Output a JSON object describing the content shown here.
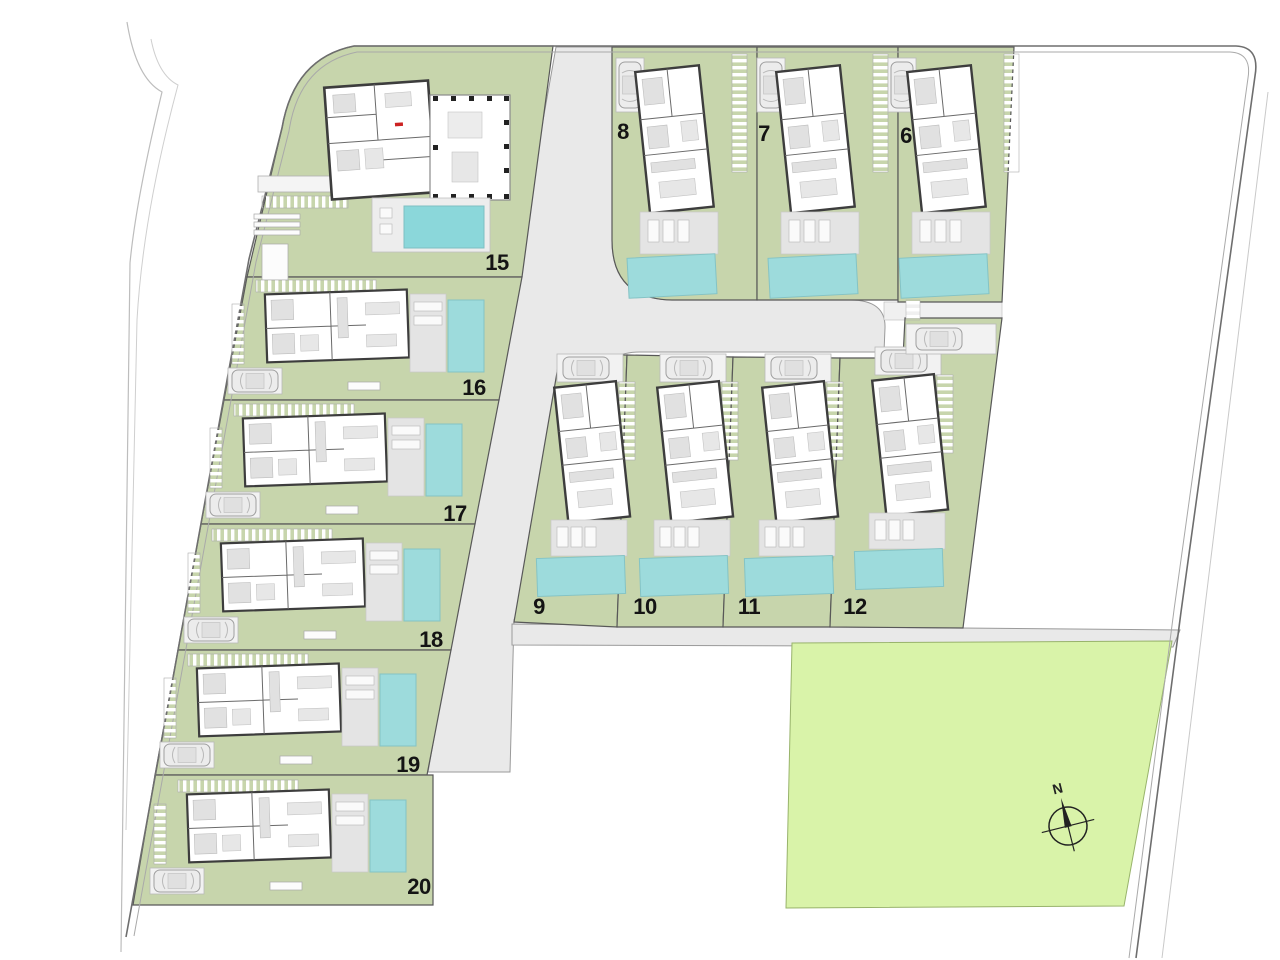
{
  "title": "Villa development site plan",
  "compass": {
    "label": "N",
    "icon": "compass-rose-icon"
  },
  "icons": {
    "car": "car-icon",
    "pool": "pool-shape",
    "compass": "compass-rose-icon"
  },
  "colors": {
    "lawn": "#c7d5ac",
    "open_space": "#d9f3a9",
    "pool": "#9ddbdc",
    "pool_big": "#8bd7da",
    "road": "#e9e9e9",
    "road_edge": "#9a9a9a",
    "boundary": "#6e6e6e",
    "boundary_light": "#a9a9a9",
    "plot_line": "#585858",
    "wall": "#3d3d3d",
    "terrace": "#e4e4e4",
    "furniture": "#e1e1e1",
    "pad": "#f2f2f2",
    "label": "#141414",
    "marker_red": "#cc2222"
  },
  "plots": [
    {
      "label": "15",
      "x": 497,
      "y": 263
    },
    {
      "label": "16",
      "x": 474,
      "y": 388
    },
    {
      "label": "17",
      "x": 455,
      "y": 514
    },
    {
      "label": "18",
      "x": 431,
      "y": 640
    },
    {
      "label": "19",
      "x": 408,
      "y": 765
    },
    {
      "label": "20",
      "x": 419,
      "y": 887
    },
    {
      "label": "8",
      "x": 623,
      "y": 132
    },
    {
      "label": "7",
      "x": 764,
      "y": 134
    },
    {
      "label": "6",
      "x": 906,
      "y": 136
    },
    {
      "label": "9",
      "x": 539,
      "y": 607
    },
    {
      "label": "10",
      "x": 645,
      "y": 607
    },
    {
      "label": "11",
      "x": 749,
      "y": 607
    },
    {
      "label": "12",
      "x": 855,
      "y": 607
    }
  ]
}
